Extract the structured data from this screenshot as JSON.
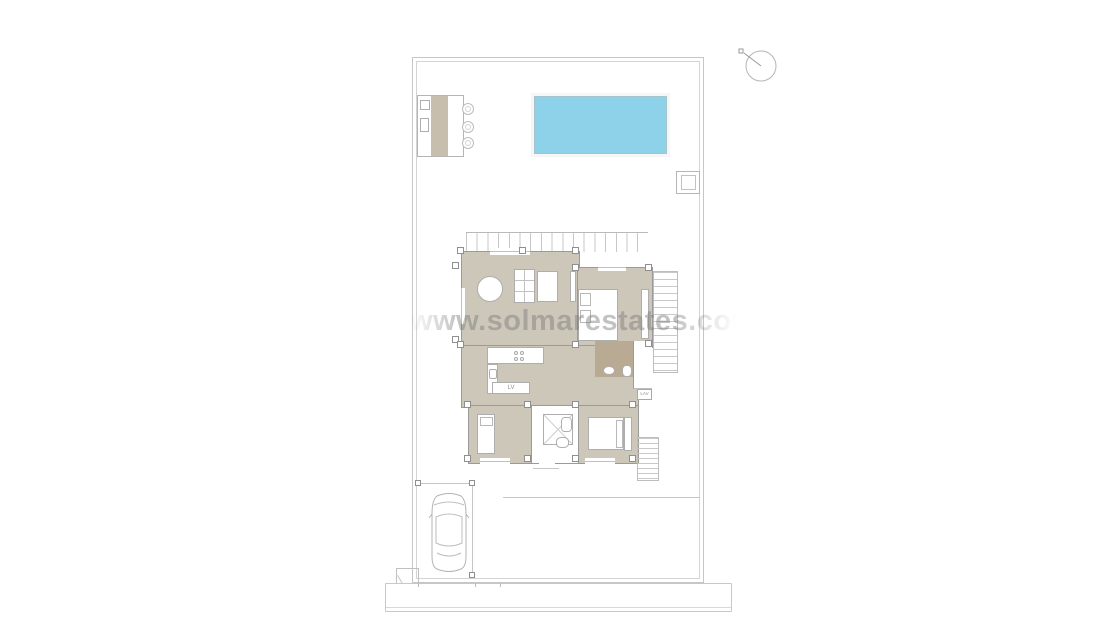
{
  "watermark": {
    "text": "www.solmarestates.com"
  },
  "plan": {
    "kitchen_island_label": "LV",
    "laundry_label": "LAV"
  },
  "colors": {
    "pool": "#8ed2ea",
    "floor": "#cdc7ba",
    "bathfloor": "#b8aa93",
    "counter": "#c8bead",
    "watermark": "#7a7a7a"
  }
}
